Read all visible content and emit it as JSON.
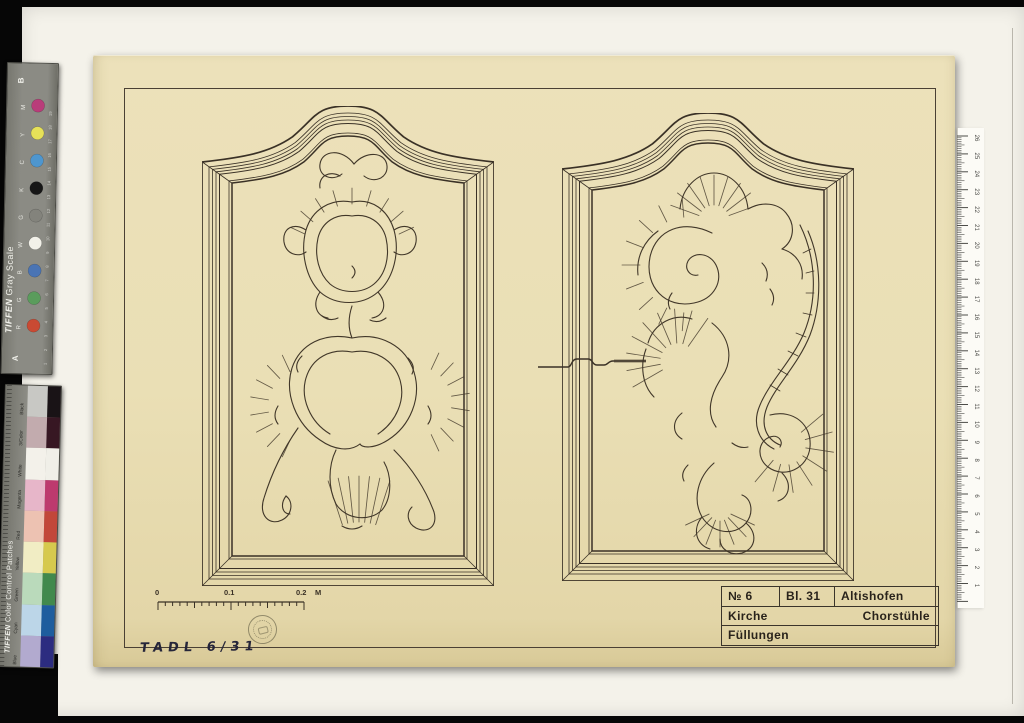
{
  "colors": {
    "background": "#060606",
    "backing_sheet": "#f4f2ea",
    "paper": "#eadfb5",
    "ink": "#413729",
    "frame_ink": "#3a3126",
    "ruled_border": "#4a4034",
    "title_text": "#29231b"
  },
  "gray_scale_strip": {
    "brand": "TIFFEN",
    "title": " Gray Scale",
    "end_top": "B",
    "end_bottom": "A",
    "rows": [
      {
        "letter": "M",
        "dot": "#b93d7a"
      },
      {
        "letter": "Y",
        "dot": "#e6e158"
      },
      {
        "letter": "C",
        "dot": "#4e96cf"
      },
      {
        "letter": "K",
        "dot": "#161616"
      },
      {
        "letter": "G",
        "dot": "#83837c"
      },
      {
        "letter": "W",
        "dot": "#f2f1e9"
      },
      {
        "letter": "B",
        "dot": "#4a74b4"
      },
      {
        "letter": "G",
        "dot": "#5a9c5c"
      },
      {
        "letter": "R",
        "dot": "#c94a33"
      }
    ],
    "scale_numbers": [
      "1",
      "2",
      "3",
      "4",
      "5",
      "6",
      "7",
      "8",
      "9",
      "10",
      "11",
      "12",
      "13",
      "14",
      "15",
      "16",
      "17",
      "18",
      "19"
    ]
  },
  "color_control_strip": {
    "brand": "TIFFEN",
    "title": " Color Control Patches",
    "patches": [
      {
        "label": "Black",
        "pale": "#c8c8c4",
        "strong": "#191316"
      },
      {
        "label": "3/Color",
        "pale": "#c2abae",
        "strong": "#371723"
      },
      {
        "label": "White",
        "pale": "#f3f1ea",
        "strong": "#f0efe8"
      },
      {
        "label": "Magenta",
        "pale": "#e7b6c9",
        "strong": "#bd3a6e"
      },
      {
        "label": "Red",
        "pale": "#edc2b2",
        "strong": "#c2473a"
      },
      {
        "label": "Yellow",
        "pale": "#f1edc4",
        "strong": "#d6c94e"
      },
      {
        "label": "Green",
        "pale": "#badabb",
        "strong": "#41894d"
      },
      {
        "label": "Cyan",
        "pale": "#bcd6e8",
        "strong": "#1e5d9e"
      },
      {
        "label": "Blue",
        "pale": "#b2aacf",
        "strong": "#2c2c80"
      }
    ]
  },
  "ruler": {
    "numbers": [
      "1",
      "2",
      "3",
      "4",
      "5",
      "6",
      "7",
      "8",
      "9",
      "10",
      "11",
      "12",
      "13",
      "14",
      "15",
      "16",
      "17",
      "18",
      "19",
      "20",
      "21",
      "22",
      "23",
      "24",
      "25",
      "26"
    ]
  },
  "drawing": {
    "scale_bar": {
      "ticks": [
        "0",
        "0.1",
        "0.2"
      ],
      "unit": "M"
    },
    "title_block": {
      "no": "№ 6",
      "sheet": "Bl. 31",
      "place": "Altishofen",
      "row2_left": "Kirche",
      "row2_right": "Chorstühle",
      "row3": "Füllungen"
    },
    "handwritten_note": "TADL 6/31"
  }
}
